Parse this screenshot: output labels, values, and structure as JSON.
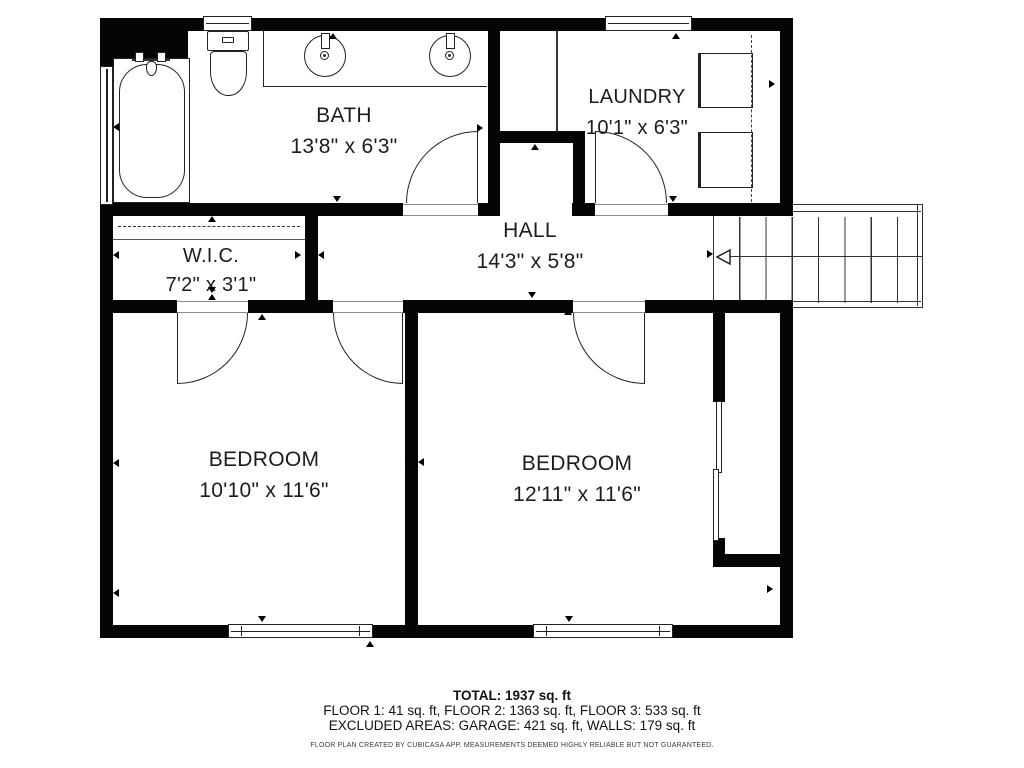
{
  "plan": {
    "rooms": [
      {
        "name": "BATH",
        "dims": "13'8\" x 6'3\""
      },
      {
        "name": "LAUNDRY",
        "dims": "10'1\" x 6'3\""
      },
      {
        "name": "HALL",
        "dims": "14'3\" x 5'8\""
      },
      {
        "name": "W.I.C.",
        "dims": "7'2\" x 3'1\""
      },
      {
        "name": "BEDROOM",
        "dims": "10'10\" x 11'6\""
      },
      {
        "name": "BEDROOM",
        "dims": "12'11\" x 11'6\""
      }
    ]
  },
  "footer": {
    "total": "TOTAL: 1937 sq. ft",
    "floors": "FLOOR 1: 41 sq. ft, FLOOR 2: 1363 sq. ft, FLOOR 3: 533 sq. ft",
    "excluded": "EXCLUDED AREAS: GARAGE: 421 sq. ft, WALLS: 179 sq. ft",
    "disclaimer": "FLOOR PLAN CREATED BY CUBICASA APP. MEASUREMENTS DEEMED HIGHLY RELIABLE BUT NOT GUARANTEED."
  },
  "markers": [
    {
      "dir": "up",
      "x": 329,
      "y": 33
    },
    {
      "dir": "left",
      "x": 113,
      "y": 123
    },
    {
      "dir": "right",
      "x": 477,
      "y": 124
    },
    {
      "dir": "down",
      "x": 333,
      "y": 196
    },
    {
      "dir": "up",
      "x": 208,
      "y": 216
    },
    {
      "dir": "left",
      "x": 113,
      "y": 251
    },
    {
      "dir": "right",
      "x": 295,
      "y": 251
    },
    {
      "dir": "down",
      "x": 208,
      "y": 287
    },
    {
      "dir": "up",
      "x": 208,
      "y": 294
    },
    {
      "dir": "up",
      "x": 531,
      "y": 144
    },
    {
      "dir": "up",
      "x": 672,
      "y": 33
    },
    {
      "dir": "right",
      "x": 769,
      "y": 80
    },
    {
      "dir": "down",
      "x": 669,
      "y": 196
    },
    {
      "dir": "left",
      "x": 318,
      "y": 251
    },
    {
      "dir": "down",
      "x": 528,
      "y": 292
    },
    {
      "dir": "up",
      "x": 258,
      "y": 314
    },
    {
      "dir": "up",
      "x": 564,
      "y": 309
    },
    {
      "dir": "left",
      "x": 113,
      "y": 459
    },
    {
      "dir": "right",
      "x": 406,
      "y": 459
    },
    {
      "dir": "down",
      "x": 258,
      "y": 616
    },
    {
      "dir": "up",
      "x": 366,
      "y": 641
    },
    {
      "dir": "left",
      "x": 418,
      "y": 458
    },
    {
      "dir": "down",
      "x": 565,
      "y": 616
    },
    {
      "dir": "right",
      "x": 767,
      "y": 585
    },
    {
      "dir": "left",
      "x": 113,
      "y": 589
    },
    {
      "dir": "right",
      "x": 707,
      "y": 250
    }
  ],
  "colors": {
    "wall": "#050505",
    "line": "#222222",
    "text": "#1c1c1c",
    "bg": "#ffffff"
  }
}
